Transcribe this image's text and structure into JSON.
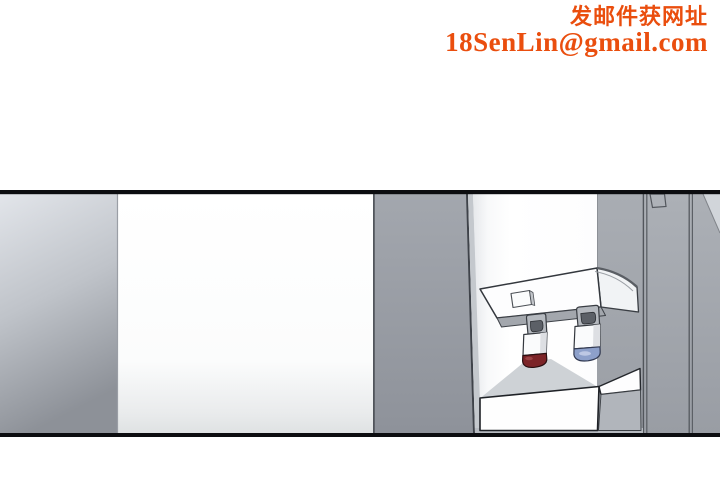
{
  "header": {
    "promo_text": "发邮件获网址",
    "email": "18SenLin@gmail.com",
    "text_color": "#ea4e0e"
  },
  "panel": {
    "type": "comic-panel",
    "scene": "room corner with a built-in water dispenser between gray wall columns",
    "colors": {
      "border": "#0c0d10",
      "hot_tap": "#7c2428",
      "cold_tap": "#8da0ca",
      "wall_gray": "#9aa0a8",
      "outline": "#33373d"
    }
  }
}
